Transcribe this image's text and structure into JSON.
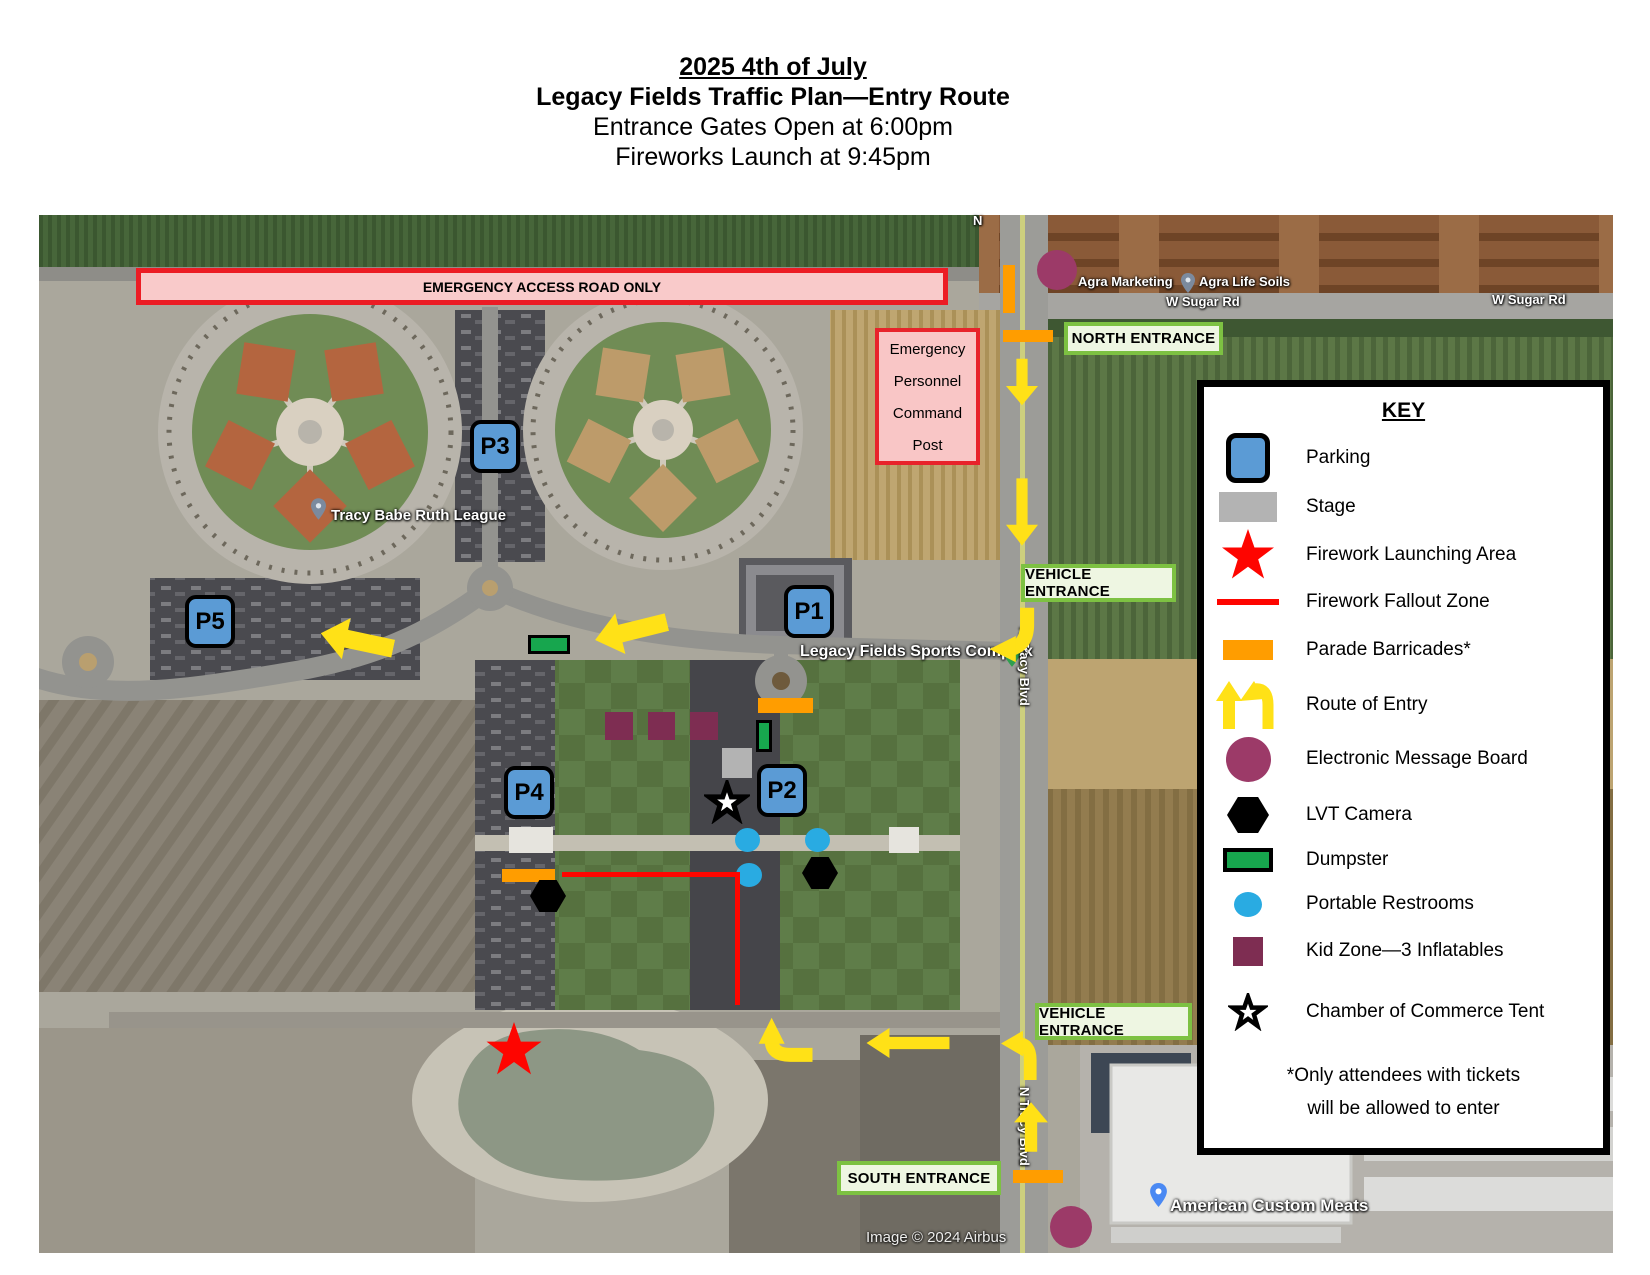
{
  "header": {
    "title": "2025 4th of July",
    "subtitle": "Legacy Fields Traffic Plan—Entry Route",
    "line3": "Entrance Gates Open at 6:00pm",
    "line4": "Fireworks Launch at 9:45pm"
  },
  "map": {
    "emergency_banner": "EMERGENCY ACCESS ROAD ONLY",
    "command_post": [
      "Emergency",
      "Personnel",
      "Command",
      "Post"
    ],
    "entrances": {
      "north": "NORTH ENTRANCE",
      "vehicle_mid": "VEHICLE ENTRANCE",
      "vehicle_south": "VEHICLE ENTRANCE",
      "south": "SOUTH ENTRANCE"
    },
    "parking": {
      "p1": "P1",
      "p2": "P2",
      "p3": "P3",
      "p4": "P4",
      "p5": "P5"
    },
    "geo_labels": {
      "road_n": "N",
      "agra_marketing": "Agra Marketing",
      "agra_life_soils": "Agra Life Soils",
      "w_sugar_rd": "W Sugar Rd",
      "tracy_babe_ruth": "Tracy Babe Ruth League",
      "sports_complex": "Legacy Fields Sports Complex",
      "n_tracy_blvd": "N Tracy Blvd",
      "american_custom_meats": "American Custom Meats",
      "image_credit": "Image © 2024 Airbus"
    }
  },
  "key": {
    "title": "KEY",
    "items": [
      {
        "icon": "parking-icon",
        "label": "Parking"
      },
      {
        "icon": "stage-icon",
        "label": "Stage"
      },
      {
        "icon": "firework-launching-area-icon",
        "label": "Firework Launching Area"
      },
      {
        "icon": "firework-fallout-zone-icon",
        "label": "Firework Fallout Zone"
      },
      {
        "icon": "parade-barricades-icon",
        "label": "Parade Barricades*"
      },
      {
        "icon": "route-of-entry-icon",
        "label": "Route of Entry"
      },
      {
        "icon": "electronic-message-board-icon",
        "label": "Electronic Message Board"
      },
      {
        "icon": "lvt-camera-icon",
        "label": "LVT Camera"
      },
      {
        "icon": "dumpster-icon",
        "label": "Dumpster"
      },
      {
        "icon": "portable-restrooms-icon",
        "label": "Portable Restrooms"
      },
      {
        "icon": "kid-zone-icon",
        "label": "Kid Zone—3 Inflatables"
      },
      {
        "icon": "chamber-tent-icon",
        "label": "Chamber of Commerce Tent"
      }
    ],
    "note": [
      "*Only attendees with tickets",
      "will be allowed to enter"
    ]
  },
  "colors": {
    "parking_blue": "#5b9bd5",
    "stage_gray": "#b3b3b3",
    "firework_red": "#fe0500",
    "barricade_orange": "#ff9d00",
    "route_yellow": "#ffe117",
    "message_board_purple": "#9c3a68",
    "dumpster_green": "#17a64e",
    "restroom_blue": "#29abe2",
    "kid_zone_maroon": "#7e2d52",
    "entrance_green": "#7dc142",
    "entrance_bg": "#eef6e2",
    "emergency_pink": "#f9caca",
    "emergency_red": "#ec1c24"
  }
}
